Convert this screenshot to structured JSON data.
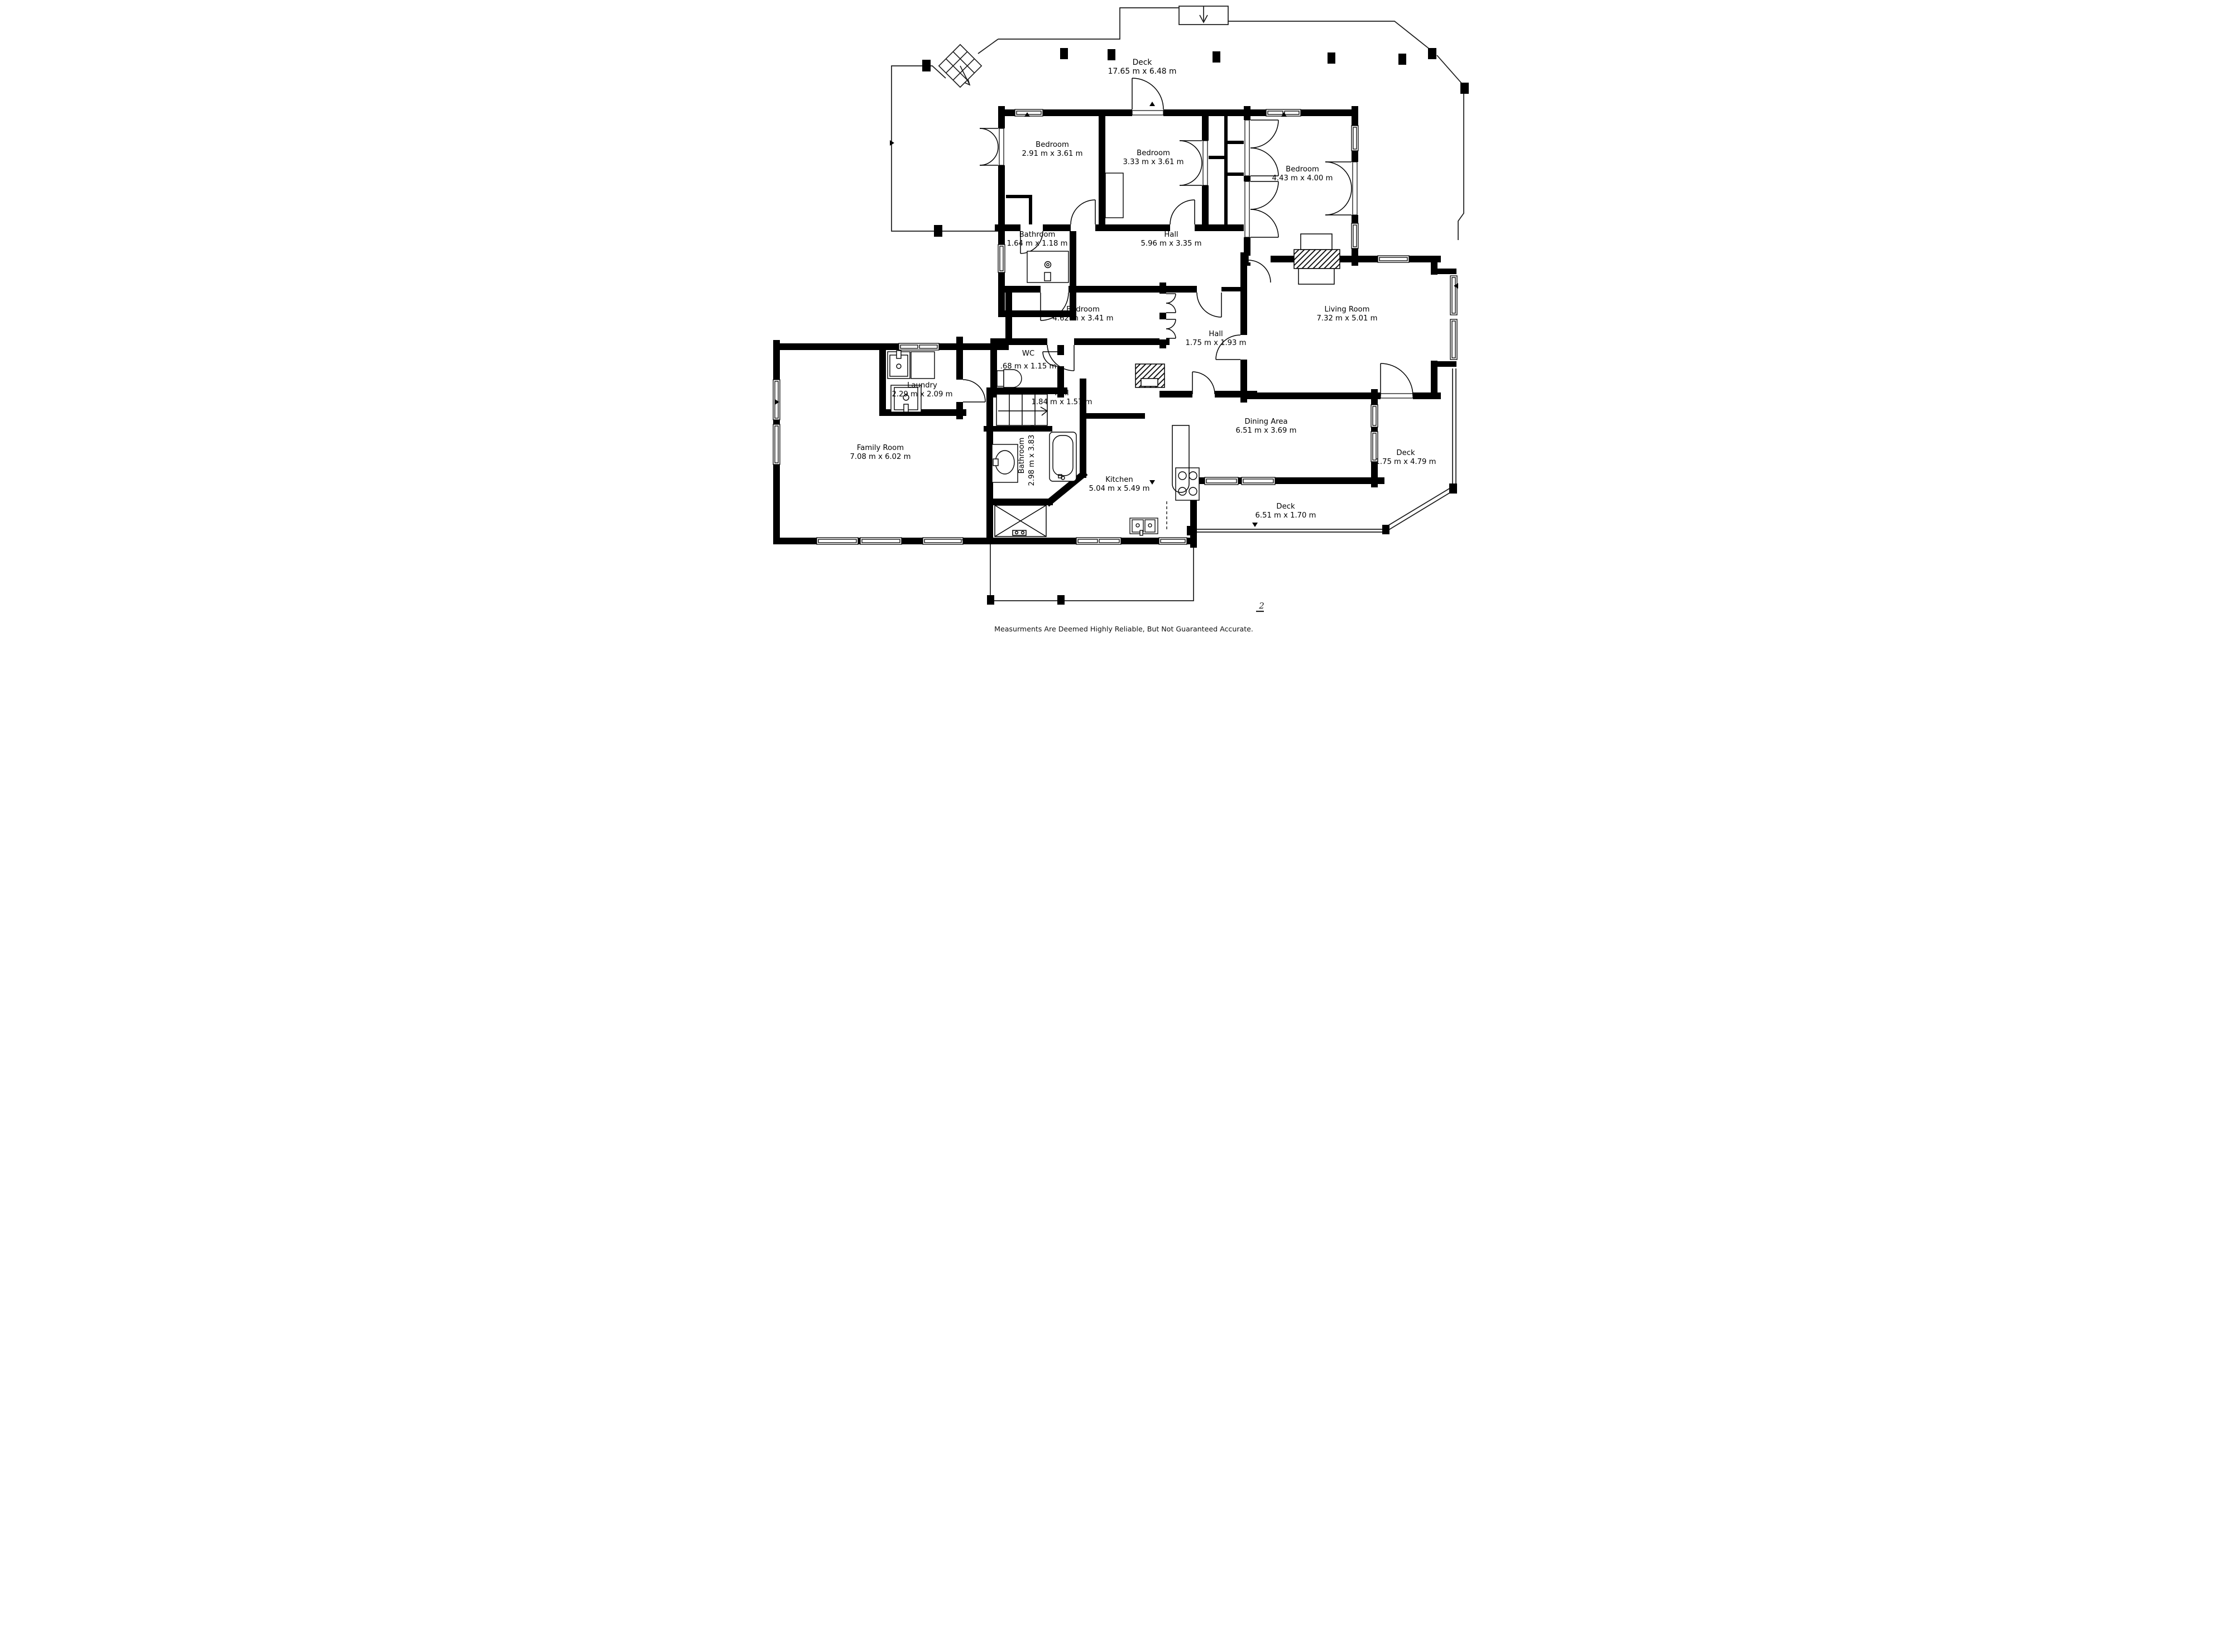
{
  "plan": {
    "disclaimer": "Measurments Are Deemed Highly Reliable, But Not Guaranteed Accurate.",
    "page_mark": "2",
    "colors": {
      "wall": "#000000",
      "deck_line": "#1a1a1a",
      "background": "#ffffff"
    }
  },
  "rooms": [
    {
      "id": "deck-top",
      "name": "Deck",
      "dims": "17.65 m x 6.48 m"
    },
    {
      "id": "bedroom-1",
      "name": "Bedroom",
      "dims": "2.91 m x 3.61 m"
    },
    {
      "id": "bedroom-2",
      "name": "Bedroom",
      "dims": "3.33 m x 3.61 m"
    },
    {
      "id": "bedroom-3",
      "name": "Bedroom",
      "dims": "4.43 m x 4.00 m"
    },
    {
      "id": "bathroom-1",
      "name": "Bathroom",
      "dims": "1.64 m x 1.18 m"
    },
    {
      "id": "hall-main",
      "name": "Hall",
      "dims": "5.96 m x 3.35 m"
    },
    {
      "id": "bedroom-4",
      "name": "Bedroom",
      "dims": "4.62 m x 3.41 m"
    },
    {
      "id": "hall-2",
      "name": "Hall",
      "dims": "1.75 m x 1.93 m"
    },
    {
      "id": "living-room",
      "name": "Living Room",
      "dims": "7.32 m x 5.01 m"
    },
    {
      "id": "wc",
      "name": "WC",
      "dims": ".68 m x 1.15 m"
    },
    {
      "id": "laundry",
      "name": "Laundry",
      "dims": "2.29 m x 2.09 m"
    },
    {
      "id": "hall-3",
      "name": "Hall",
      "dims": "1.84 m x 1.57 m"
    },
    {
      "id": "family-room",
      "name": "Family Room",
      "dims": "7.08 m x 6.02 m"
    },
    {
      "id": "bathroom-2",
      "name": "Bathroom",
      "dims": "2.98 m x 3.83 m"
    },
    {
      "id": "kitchen",
      "name": "Kitchen",
      "dims": "5.04 m x 5.49 m"
    },
    {
      "id": "dining-area",
      "name": "Dining Area",
      "dims": "6.51 m x 3.69 m"
    },
    {
      "id": "deck-right",
      "name": "Deck",
      "dims": "1.75 m x 4.79 m"
    },
    {
      "id": "deck-bottom",
      "name": "Deck",
      "dims": "6.51 m x 1.70 m"
    }
  ]
}
